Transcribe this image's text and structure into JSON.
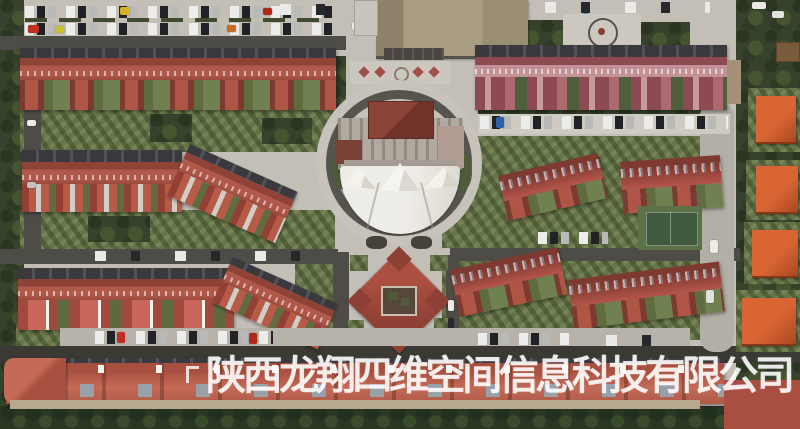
{
  "scene": {
    "type": "aerial-satellite-photo",
    "subject": "residential compound with red-roofed townhouse rows, central circular plaza with white membrane canopy, pinwheel courtyard building, parking lots, basketball court and orange-roofed villas"
  },
  "watermark": {
    "text": "陕西龙翔四维空间信息科技有限公司",
    "color": "#ffffff",
    "opacity": 0.84
  },
  "palette": {
    "pavement": "#c3bfb7",
    "road_dark": "#4e4c47",
    "road_black": "#3a3934",
    "roof_red": "#b0584a",
    "roof_dark_red": "#8f4236",
    "roof_pink": "#c39296",
    "roof_orange": "#cd5a2e",
    "roof_tan": "#a89d83",
    "tree_dark": "#36422c",
    "grass": "#66744a",
    "canopy_white": "#f1efe9",
    "court_green": "#3f5a3e"
  }
}
